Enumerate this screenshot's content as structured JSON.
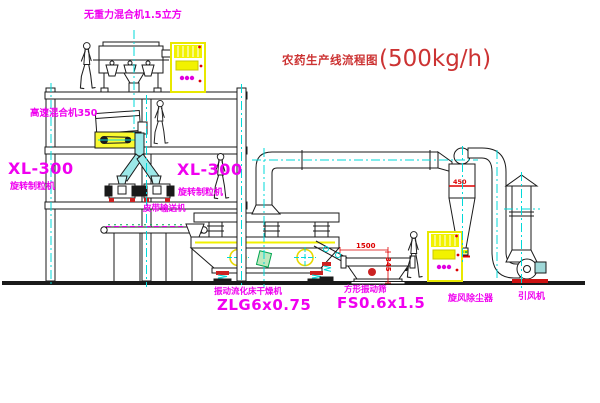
{
  "title": {
    "zh": "农药生产线流程图",
    "capacity": "(500kg/h)"
  },
  "labels": {
    "gravity_mixer": "无重力混合机1.5立方",
    "high_speed_mixer": "高速混合机350",
    "granulator_left_model": "XL-300",
    "granulator_left_name": "旋转制粒机",
    "granulator_right_model": "XL-300",
    "granulator_right_name": "旋转制粒机",
    "belt_conveyor": "皮带输送机",
    "dryer_name": "振动流化床干燥机",
    "dryer_model": "ZLG6x0.75",
    "screen_name": "方形振动筛",
    "screen_model": "FS0.6x1.5",
    "cyclone": "旋风除尘器",
    "fan": "引风机"
  },
  "dimensions": {
    "screen_length": "1500",
    "screen_height": "345",
    "cyclone_dia": "450"
  },
  "colors": {
    "label_magenta": "#F000F0",
    "title_red": "#CC3333",
    "dimension_red": "#DD0000",
    "centerline_cyan": "#00D9D9",
    "highlight_yellow": "#F2F200",
    "line_black": "#1A1A1A"
  }
}
